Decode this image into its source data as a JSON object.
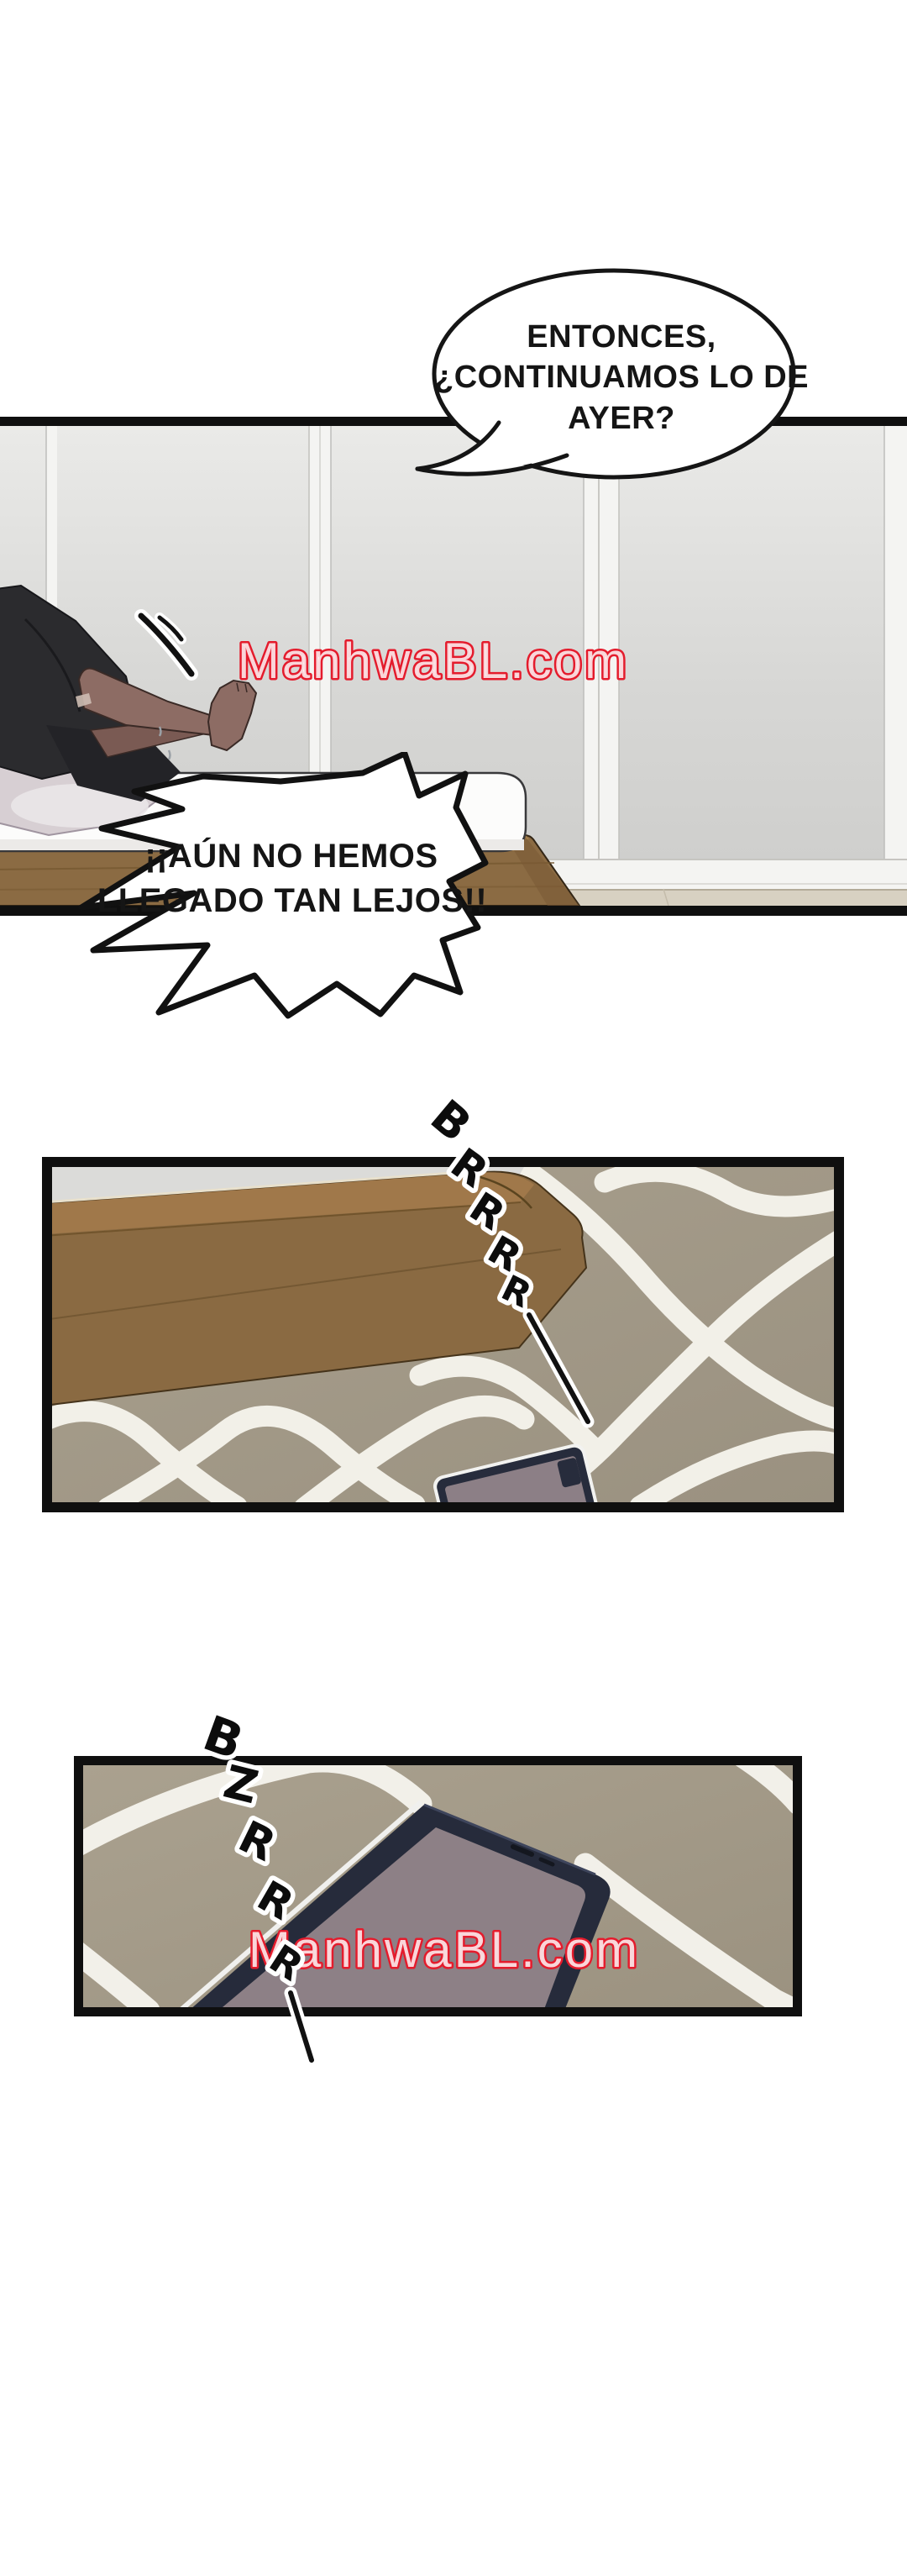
{
  "page": {
    "background": "#ffffff"
  },
  "watermark": {
    "text": "ManhwaBL.com",
    "color": "#e41b2c"
  },
  "speech_bubble": {
    "lines": [
      "ENTONCES,",
      "¿CONTINUAMOS LO DE",
      "AYER?"
    ]
  },
  "burst_bubble": {
    "lines": [
      "¡¡AÚN NO HEMOS",
      "LLEGADO TAN LEJOS!!"
    ]
  },
  "sfx": {
    "buzz1": {
      "letters": [
        "B",
        "R",
        "R",
        "R",
        "R"
      ]
    },
    "buzz2": {
      "letters": [
        "B",
        "Z",
        "R",
        "R",
        "R"
      ]
    }
  },
  "colors": {
    "panel_border": "#0f0f0f",
    "wall_gray": "#d9d9d7",
    "wood_brown": "#8a6a42",
    "carpet_taupe": "#9f9685",
    "carpet_pattern_white": "#f5f3ec",
    "phone_body_navy": "#262b3b",
    "phone_screen_mauve": "#8d8086",
    "skin_tone": "#8d6c64",
    "watermark_red": "#e41b2c"
  }
}
